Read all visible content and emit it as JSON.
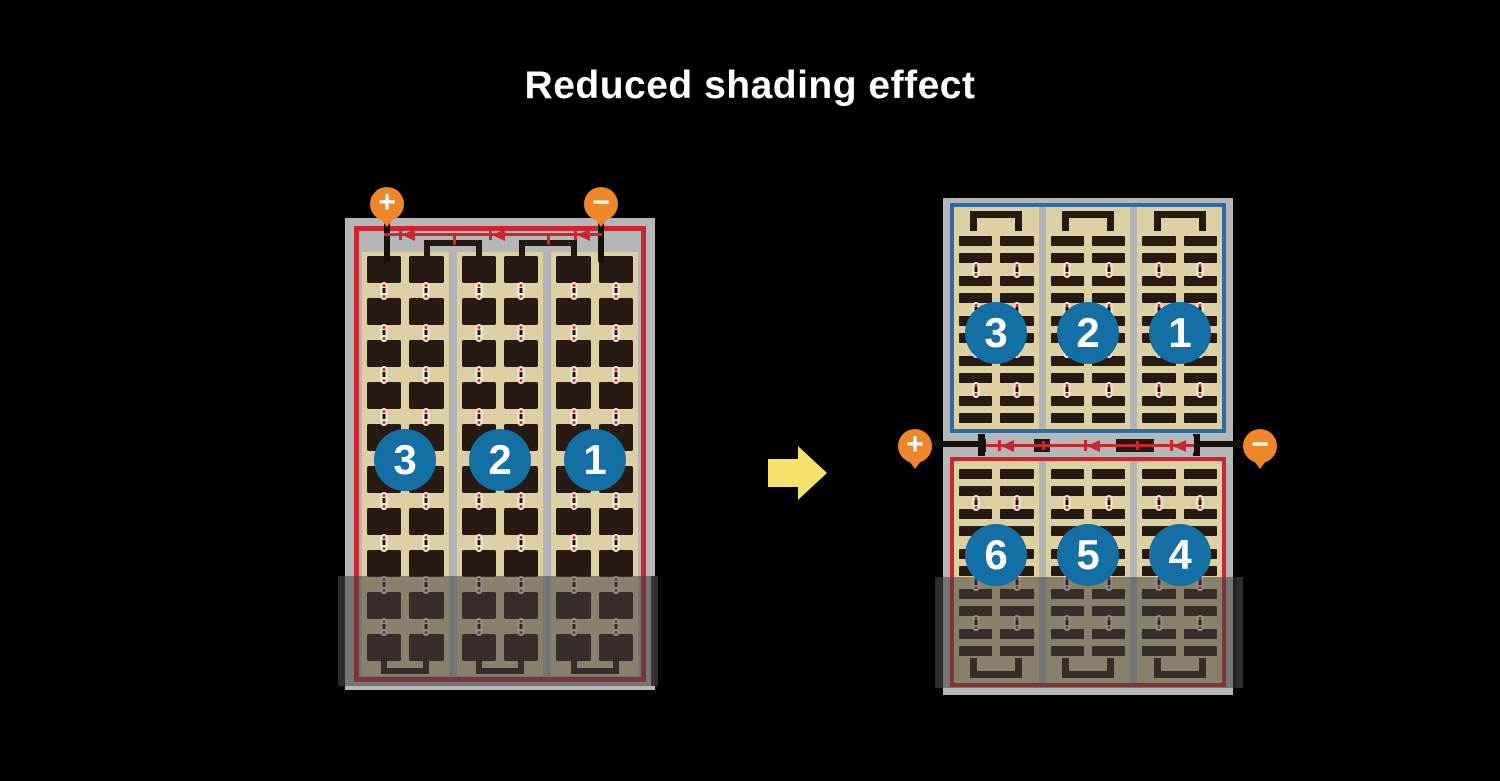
{
  "title": "Reduced shading effect",
  "left_panel": {
    "terminal_positive": "+",
    "terminal_negative": "−",
    "strings": [
      "3",
      "2",
      "1"
    ],
    "rows": 10,
    "columns_per_string": 2,
    "bypass_diodes": 3
  },
  "right_panel": {
    "terminal_positive": "+",
    "terminal_negative": "−",
    "top_strings": [
      "3",
      "2",
      "1"
    ],
    "bottom_strings": [
      "6",
      "5",
      "4"
    ],
    "bars_per_half": 10,
    "columns_per_string": 2,
    "bypass_diodes": 3
  },
  "colors": {
    "background": "#000000",
    "frame_gray": "#b5b6b8",
    "panel_tan": "#dccfa2",
    "cell_dark": "#271a12",
    "wire_black": "#16100a",
    "red": "#c9262d",
    "blue": "#2d6ca5",
    "badge_blue": "#146fa5",
    "terminal_orange": "#ef8728",
    "arrow_yellow": "#f7e26e",
    "title_white": "#ffffff"
  }
}
